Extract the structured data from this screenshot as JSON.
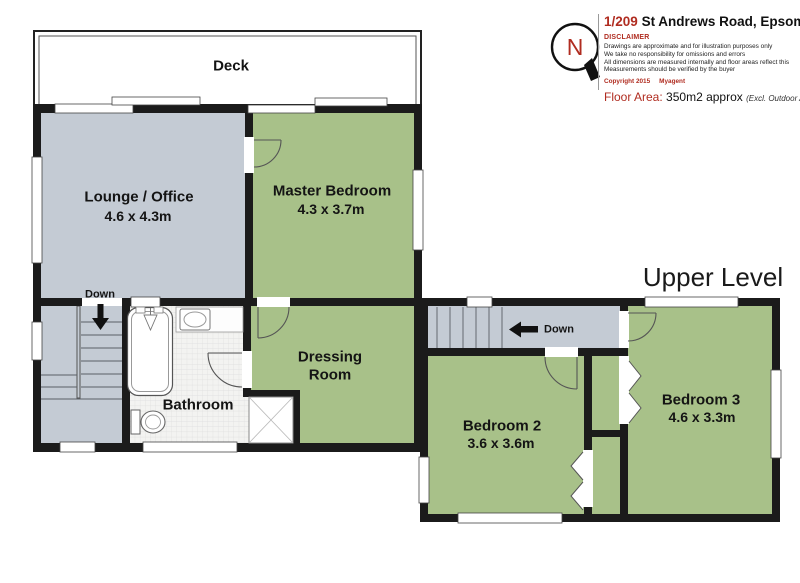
{
  "header": {
    "compass_letter": "N",
    "address_number": "1/209",
    "address_rest": "St Andrews Road, Epsom",
    "disclaimer_title": "DISCLAIMER",
    "disclaimer_lines": [
      "Drawings are approximate and for illustration purposes only",
      "We take no responsibility for omissions and errors",
      "All dimensions are measured internally and floor areas reflect this",
      "Measurements should be verified by the buyer"
    ],
    "copyright_left": "Copyright 2015",
    "copyright_right": "Myagent",
    "floor_area_label": "Floor Area:",
    "floor_area_value": "350m2 approx",
    "floor_area_note": "(Excl. Outdoor Areas)"
  },
  "plan": {
    "level_label": "Upper Level",
    "deck_label": "Deck",
    "lounge_name": "Lounge / Office",
    "lounge_dims": "4.6 x 4.3m",
    "master_name": "Master Bedroom",
    "master_dims": "4.3 x 3.7m",
    "dressing_line1": "Dressing",
    "dressing_line2": "Room",
    "bathroom_name": "Bathroom",
    "bedroom2_name": "Bedroom 2",
    "bedroom2_dims": "3.6 x 3.6m",
    "bedroom3_name": "Bedroom 3",
    "bedroom3_dims": "4.6 x 3.3m",
    "stair_left_label": "Down",
    "stair_right_label": "Down"
  },
  "colors": {
    "room_green": "#a8c189",
    "room_gray": "#c4cbd4",
    "wall": "#1b1b1b",
    "accent_red": "#b02c20"
  }
}
